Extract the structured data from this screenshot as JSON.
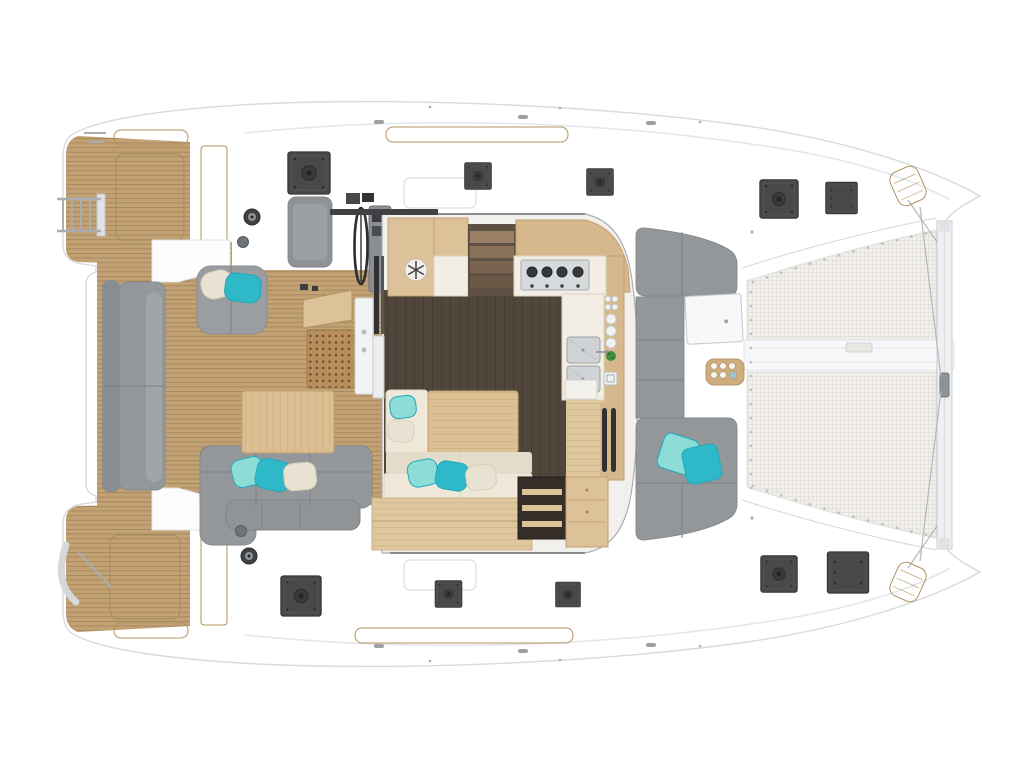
{
  "meta": {
    "title": "Catamaran deck and interior floor plan (top view)",
    "view": "top-down cutaway deck plan, bows to the right, transoms to the left",
    "canvas": {
      "width": 1024,
      "height": 768
    }
  },
  "colors": {
    "bg": "#ffffff",
    "hull": "#f8f9fa",
    "hullEdge": "#d7dbde",
    "seam": "#e4e7ea",
    "deckLine": "#d2d6d9",
    "teak": "#c2a173",
    "teakLine": "#a2835a",
    "teakLight": "#cdb083",
    "teakEdge": "#b0935f",
    "grate": "#b78e5c",
    "grateDot": "#6e4f2c",
    "woodLight": "#ddc199",
    "woodMid": "#d6b88c",
    "woodTable": "#dcc094",
    "woodEdge": "#c1a170",
    "woodFloor": "#dfc8a0",
    "woodFloorLine": "#c9ad7e",
    "floorDark": "#51463c",
    "floorDarkLine": "#463b33",
    "counter": "#f2eee4",
    "counterEdge": "#d9d3c4",
    "cream": "#efe8d9",
    "creamDark": "#e4dccb",
    "sofa": "#949799",
    "sofaDark": "#85888b",
    "sofaSplit": "#7e8184",
    "pad": "#9b9ea1",
    "benchBack": "#8a8d90",
    "hatch": "#47494b",
    "hatchEdge": "#303234",
    "steel": "#d2d6d9",
    "steelDark": "#9aa0a5",
    "mesh": "#f2f0ec",
    "meshLine": "#dcd8d1",
    "beam": "#f7f8f9",
    "beamEdge": "#dfe2e5",
    "chrome": "#a7adb2",
    "wire": "#b3b8bc",
    "lacing": "#b9bec2",
    "teal": "#2fb9c8",
    "tealDeep": "#1ea9bc",
    "tealLight": "#8edcd6",
    "pillowWhite": "#e9e1d2",
    "pillowShade": "#d9cfbc",
    "plant": "#3e8f3c",
    "winch": "#3f4143",
    "white": "#fdfdfe",
    "doorDark": "#2f3133"
  },
  "components": {
    "hull": "Catamaran hull and side decks",
    "trampoline": "Bow trampoline nets with lacing",
    "crossbeam": "Forward crossbeam with forestay fitting",
    "foredeckLounge": "Forward deck C-shaped lounge with cushions",
    "saloon": "Open saloon cabin (roof cutaway)",
    "galley": "L-shaped galley: fridge, companionway steps, 4-burner cooktop, double sink",
    "dining": "Saloon dining table with sofa and scatter cushions",
    "aftCockpit": "Aft cockpit with teak sole, sofas and table",
    "helm": "Helm station with wheel and console",
    "portTransom": "Port transom swim platform",
    "starboardTransom": "Starboard transom swim platform",
    "swimLadder": "Telescopic swim ladder",
    "deckHatch": "Flush deck hatch",
    "fridgeIcon": "Snowflake fridge icon",
    "bowPad": "Teak bow step pad",
    "cupholders": "Cockpit cup-holder tray"
  }
}
